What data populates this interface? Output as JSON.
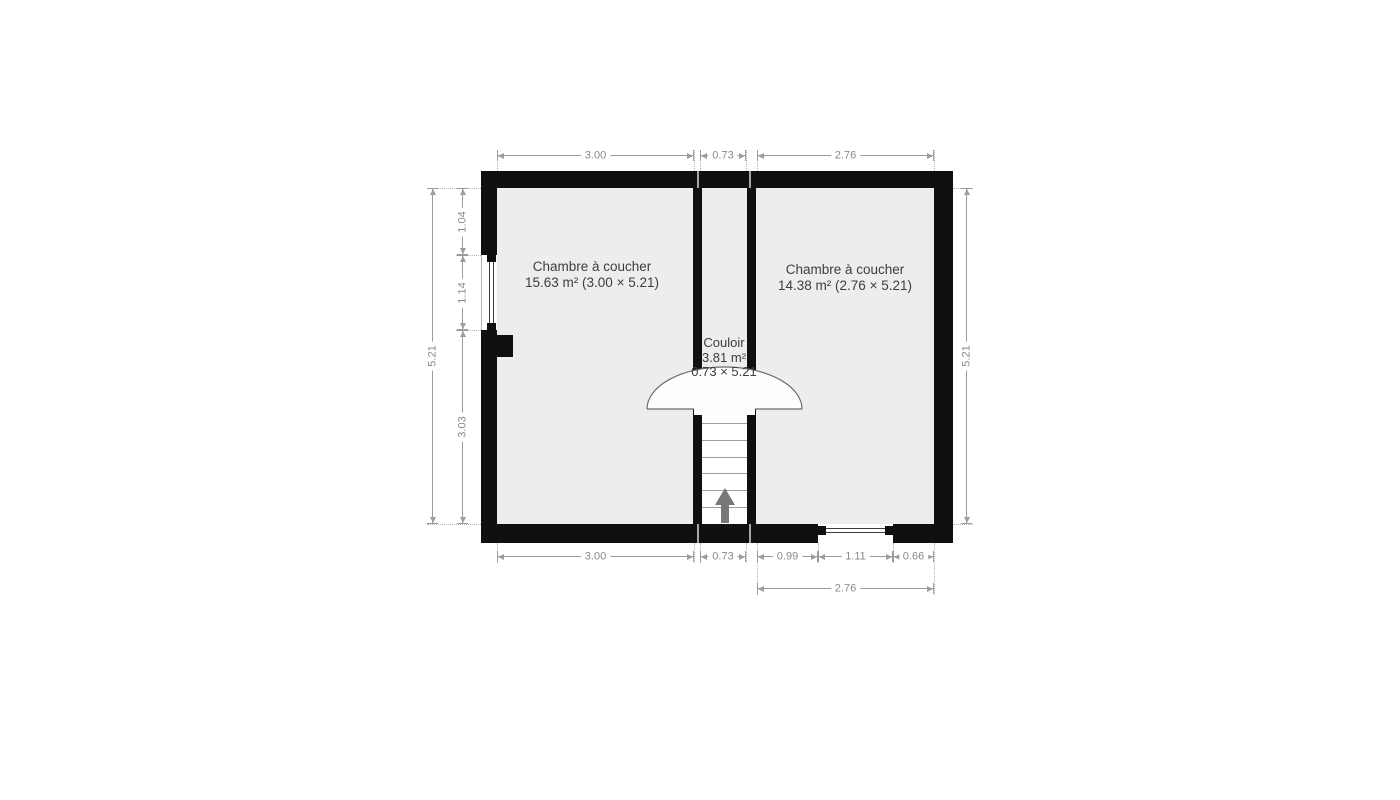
{
  "floorplan": {
    "rooms": [
      {
        "id": "bedroom-1",
        "name": "Chambre à coucher",
        "details": "15.63 m² (3.00 × 5.21)"
      },
      {
        "id": "bedroom-2",
        "name": "Chambre à coucher",
        "details": "14.38 m² (2.76 × 5.21)"
      },
      {
        "id": "corridor",
        "name": "Couloir",
        "area": "3.81 m²",
        "size": "0.73 × 5.21"
      }
    ],
    "dimensions": {
      "top": [
        "3.00",
        "0.73",
        "2.76"
      ],
      "bottom": [
        "3.00",
        "0.73",
        "0.99",
        "1.11",
        "0.66"
      ],
      "bottom_overall": "2.76",
      "left_overall": "5.21",
      "left_segments": [
        "1.04",
        "1.14",
        "3.03"
      ],
      "right_overall": "5.21"
    },
    "symbols": {
      "stairs_arrow": "up",
      "windows": 2,
      "door_arc": 1
    },
    "colors": {
      "wall": "#101010",
      "room_fill": "#ededed",
      "dimension": "#8a8a8a",
      "label_text": "#3d3d3d",
      "stairs_arrow": "#787878"
    }
  }
}
